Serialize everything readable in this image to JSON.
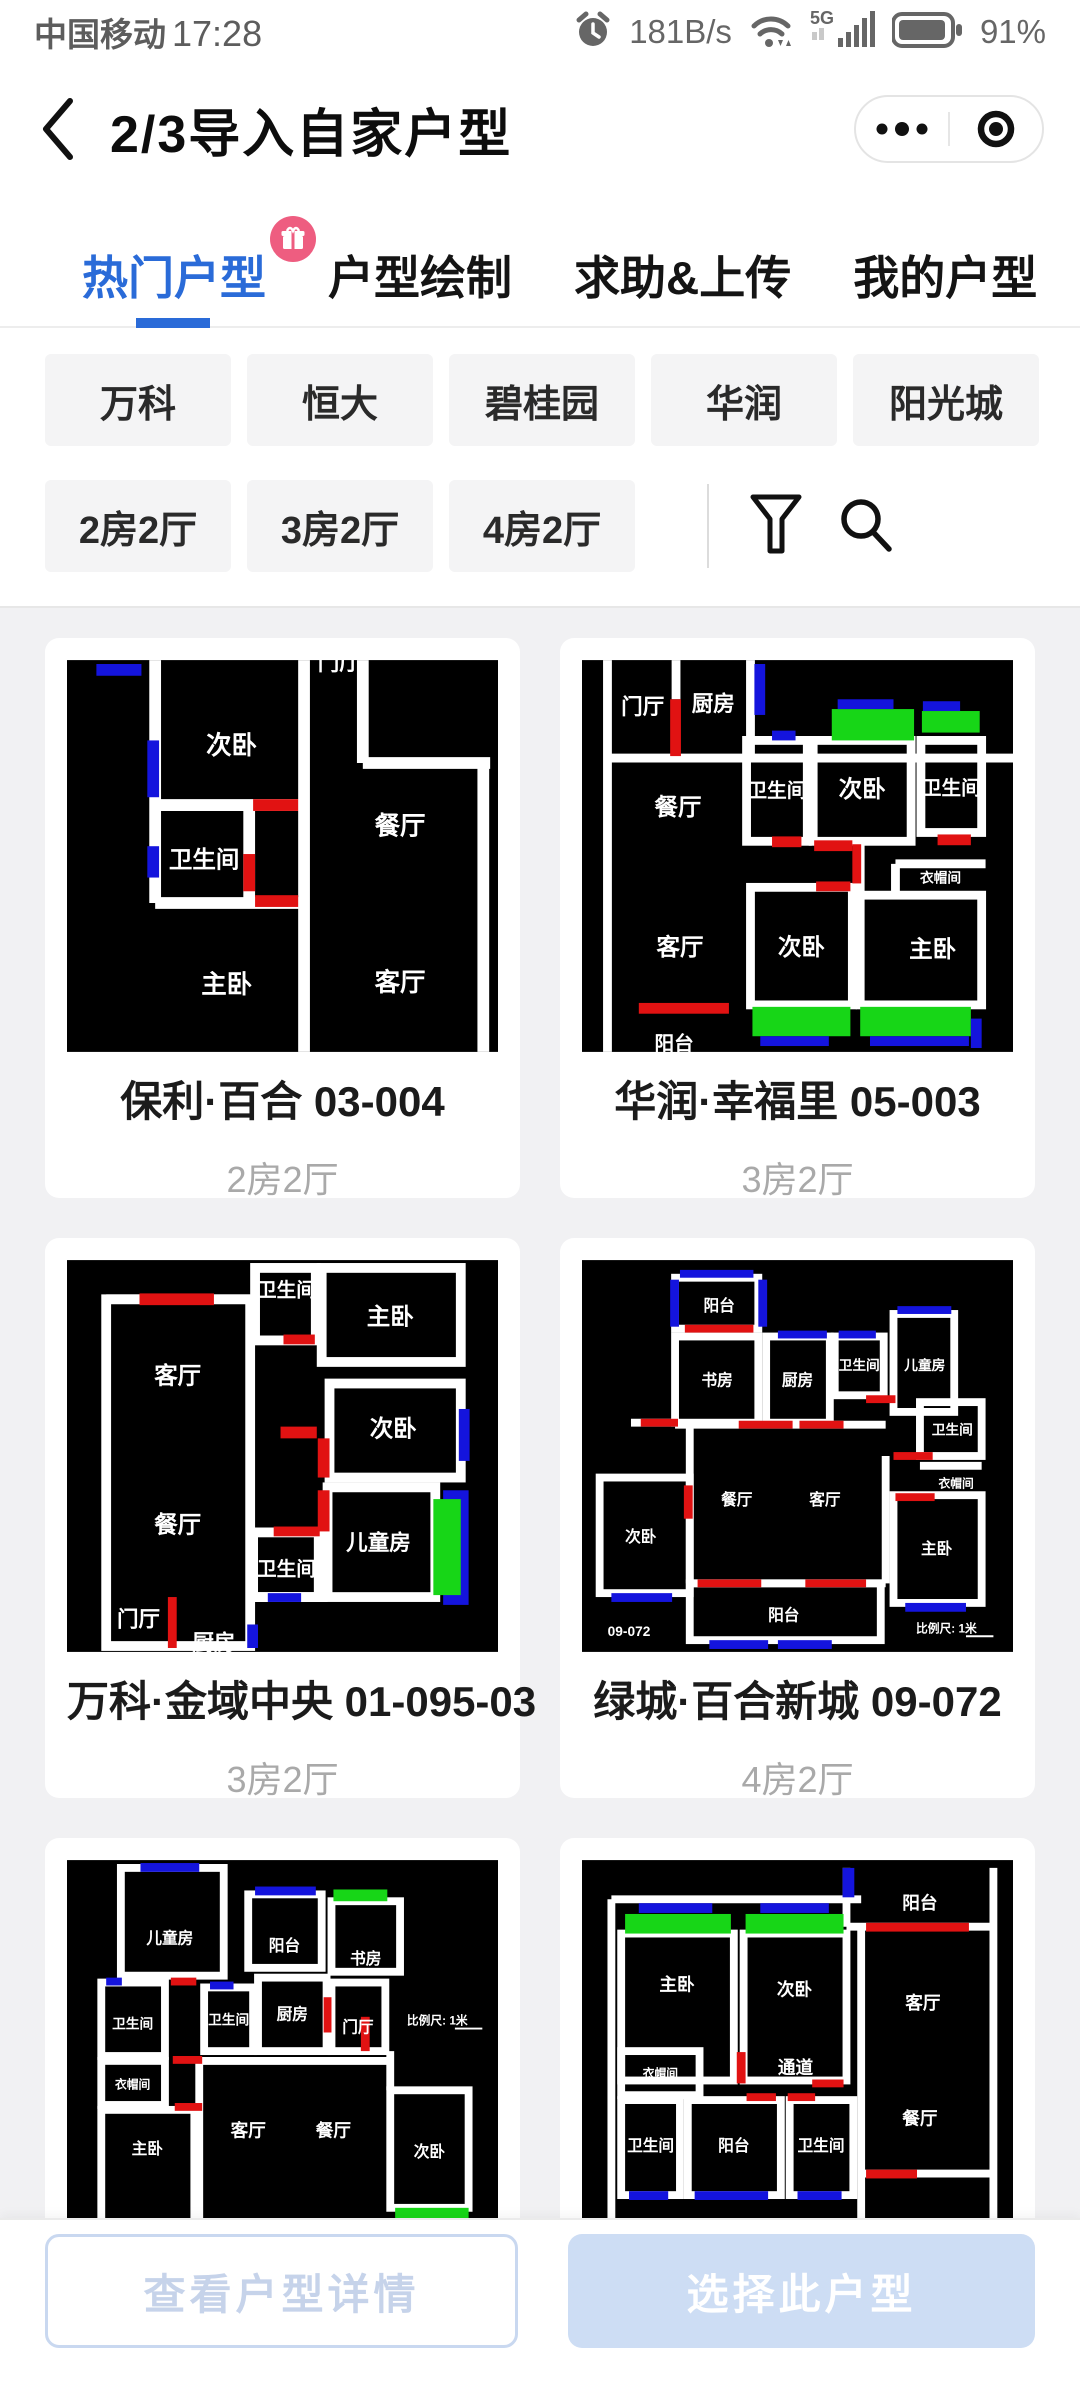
{
  "status_bar": {
    "carrier": "中国移动",
    "time": "17:28",
    "net_speed": "181B/s",
    "network": "5G",
    "battery": "91%"
  },
  "nav": {
    "title": "2/3导入自家户型"
  },
  "tabs": [
    {
      "label": "热门户型",
      "active": true,
      "badge": "gift"
    },
    {
      "label": "户型绘制",
      "active": false
    },
    {
      "label": "求助&上传",
      "active": false
    },
    {
      "label": "我的户型",
      "active": false
    }
  ],
  "filters": {
    "brands": [
      "万科",
      "恒大",
      "碧桂园",
      "华润",
      "阳光城"
    ],
    "layouts": [
      "2房2厅",
      "3房2厅",
      "4房2厅"
    ]
  },
  "cards": [
    {
      "title": "保利·百合 03-004",
      "subtitle": "2房2厅",
      "rooms": [
        "门厅",
        "次卧",
        "餐厅",
        "卫生间",
        "主卧",
        "客厅"
      ]
    },
    {
      "title": "华润·幸福里 05-003",
      "subtitle": "3房2厅",
      "rooms": [
        "门厅",
        "厨房",
        "卫生间",
        "次卧",
        "卫生间",
        "餐厅",
        "衣帽间",
        "客厅",
        "次卧",
        "主卧",
        "阳台"
      ]
    },
    {
      "title": "万科·金域中央 01-095-03",
      "subtitle": "3房2厅",
      "rooms": [
        "卫生间",
        "主卧",
        "客厅",
        "次卧",
        "餐厅",
        "儿童房",
        "卫生间",
        "门厅",
        "厨房"
      ]
    },
    {
      "title": "绿城·百合新城 09-072",
      "subtitle": "4房2厅",
      "rooms": [
        "阳台",
        "书房",
        "厨房",
        "卫生间",
        "儿童房",
        "卫生间",
        "衣帽间",
        "餐厅",
        "客厅",
        "次卧",
        "主卧",
        "阳台"
      ],
      "corner_label": "09-072",
      "scale_label": "比例尺: 1米"
    },
    {
      "rooms": [
        "儿童房",
        "阳台",
        "书房",
        "卫生间",
        "卫生间",
        "厨房",
        "门厅",
        "衣帽间",
        "主卧",
        "客厅",
        "餐厅",
        "次卧"
      ],
      "scale_label": "比例尺: 1米"
    },
    {
      "rooms": [
        "阳台",
        "主卧",
        "次卧",
        "客厅",
        "衣帽间",
        "通道",
        "卫生间",
        "阳台",
        "卫生间",
        "餐厅"
      ]
    }
  ],
  "footer": {
    "view_details": "查看户型详情",
    "select": "选择此户型"
  },
  "colors": {
    "accent": "#2a6bd8",
    "badge": "#ee5d80",
    "door_red": "#e11212",
    "window_blue": "#1414dd",
    "balcony_green": "#17d617",
    "select_btn": "#cdddf4"
  }
}
